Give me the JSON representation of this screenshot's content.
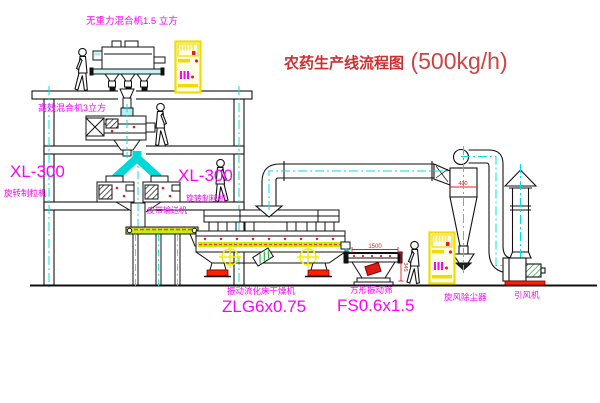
{
  "title": {
    "zh": "农药生产线流程图",
    "capacity": "(500kg/h)"
  },
  "labels": {
    "top_mixer": "无重力混合机1.5 立方",
    "mid_mixer": "高效混合机3立方",
    "granulator_model_left": "XL-300",
    "granulator_model_right": "XL-300",
    "granulator_name_left": "旋转制粒机",
    "granulator_name_right": "旋转制粒机",
    "belt_conveyor": "皮带输送机",
    "dryer_name": "振动流化床干燥机",
    "dryer_model": "ZLG6x0.75",
    "sieve_name": "方形振动筛",
    "sieve_model": "FS0.6x1.5",
    "cyclone_name": "旋风除尘器",
    "fan_name": "引风机"
  },
  "dimensions": {
    "sieve_width": "1500",
    "sieve_height": "345",
    "cyclone_inlet": "400"
  },
  "colors": {
    "label_magenta": "#ff00ff",
    "title_red": "#cc3030",
    "line_ink": "#111111",
    "centerline_cyan": "#00e0e0",
    "cabinet_yellow": "#f0dc00",
    "deck_green": "#c3ef00",
    "alert_red": "#ff2000"
  }
}
